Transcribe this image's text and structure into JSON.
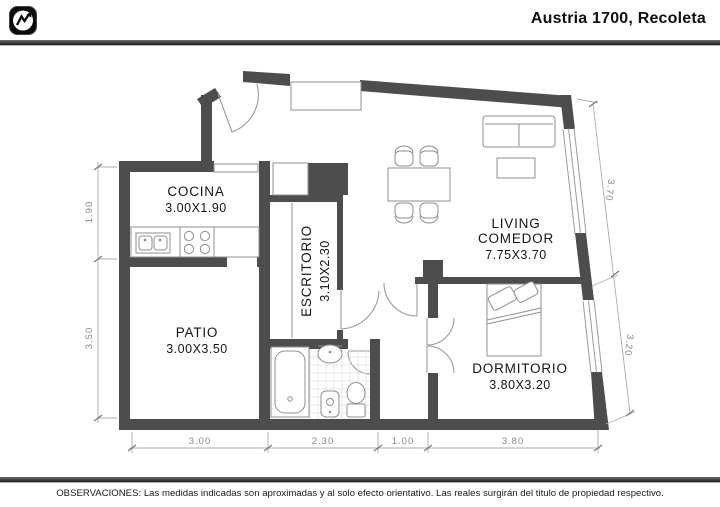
{
  "header": {
    "title": "Austria 1700, Recoleta"
  },
  "plan": {
    "rooms": {
      "cocina": {
        "name": "COCINA",
        "size": "3.00X1.90"
      },
      "patio": {
        "name": "PATIO",
        "size": "3.00X3.50"
      },
      "escritorio": {
        "name": "ESCRITORIO",
        "size": "3.10X2.30"
      },
      "living": {
        "name": "LIVING",
        "name2": "COMEDOR",
        "size": "7.75X3.70"
      },
      "dormitorio": {
        "name": "DORMITORIO",
        "size": "3.80X3.20"
      }
    },
    "dims": {
      "left": [
        "1.90",
        "3.50"
      ],
      "bottom": [
        "3.00",
        "2.30",
        "1.00",
        "3.80"
      ],
      "right": [
        "3.70",
        "3.20"
      ]
    },
    "colors": {
      "wall": "#4d4d4d",
      "line": "#909090"
    }
  },
  "footer": {
    "observations": "OBSERVACIONES: Las medidas indicadas son aproximadas y al solo efecto orientativo. Las reales surgirán del titulo de propiedad respectivo."
  }
}
